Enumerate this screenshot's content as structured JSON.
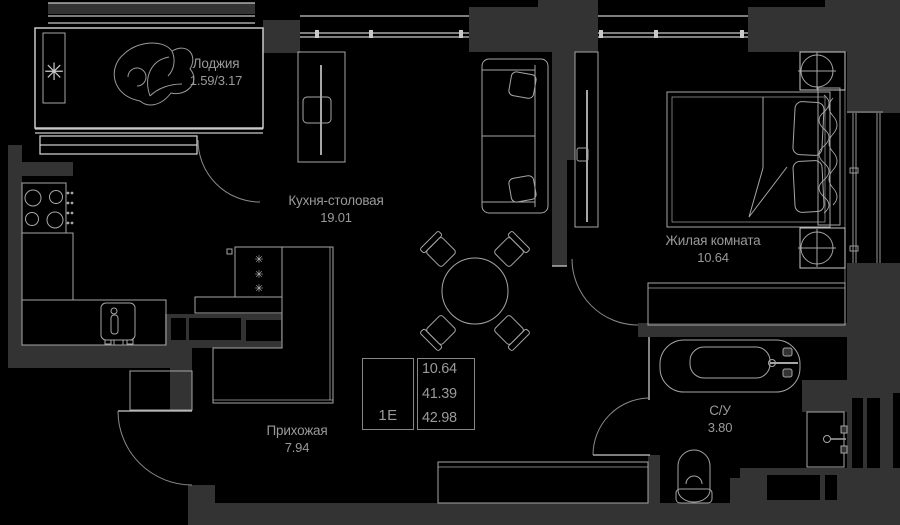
{
  "rooms": {
    "loggia": {
      "name": "Лоджия",
      "area": "1.59/3.17"
    },
    "kitchen": {
      "name": "Кухня-столовая",
      "area": "19.01"
    },
    "living": {
      "name": "Жилая комната",
      "area": "10.64"
    },
    "hallway": {
      "name": "Прихожая",
      "area": "7.94"
    },
    "bathroom": {
      "name": "С/У",
      "area": "3.80"
    }
  },
  "info_table": {
    "unit_type": "1Е",
    "areas": [
      "10.64",
      "41.39",
      "42.98"
    ]
  },
  "icons": {
    "snowflake": "✳"
  },
  "colors": {
    "background": "#000000",
    "wall": "#333333",
    "furniture_line": "#a6a6a6",
    "bright_line": "#c9c9c9",
    "text": "#9a9a9a"
  }
}
